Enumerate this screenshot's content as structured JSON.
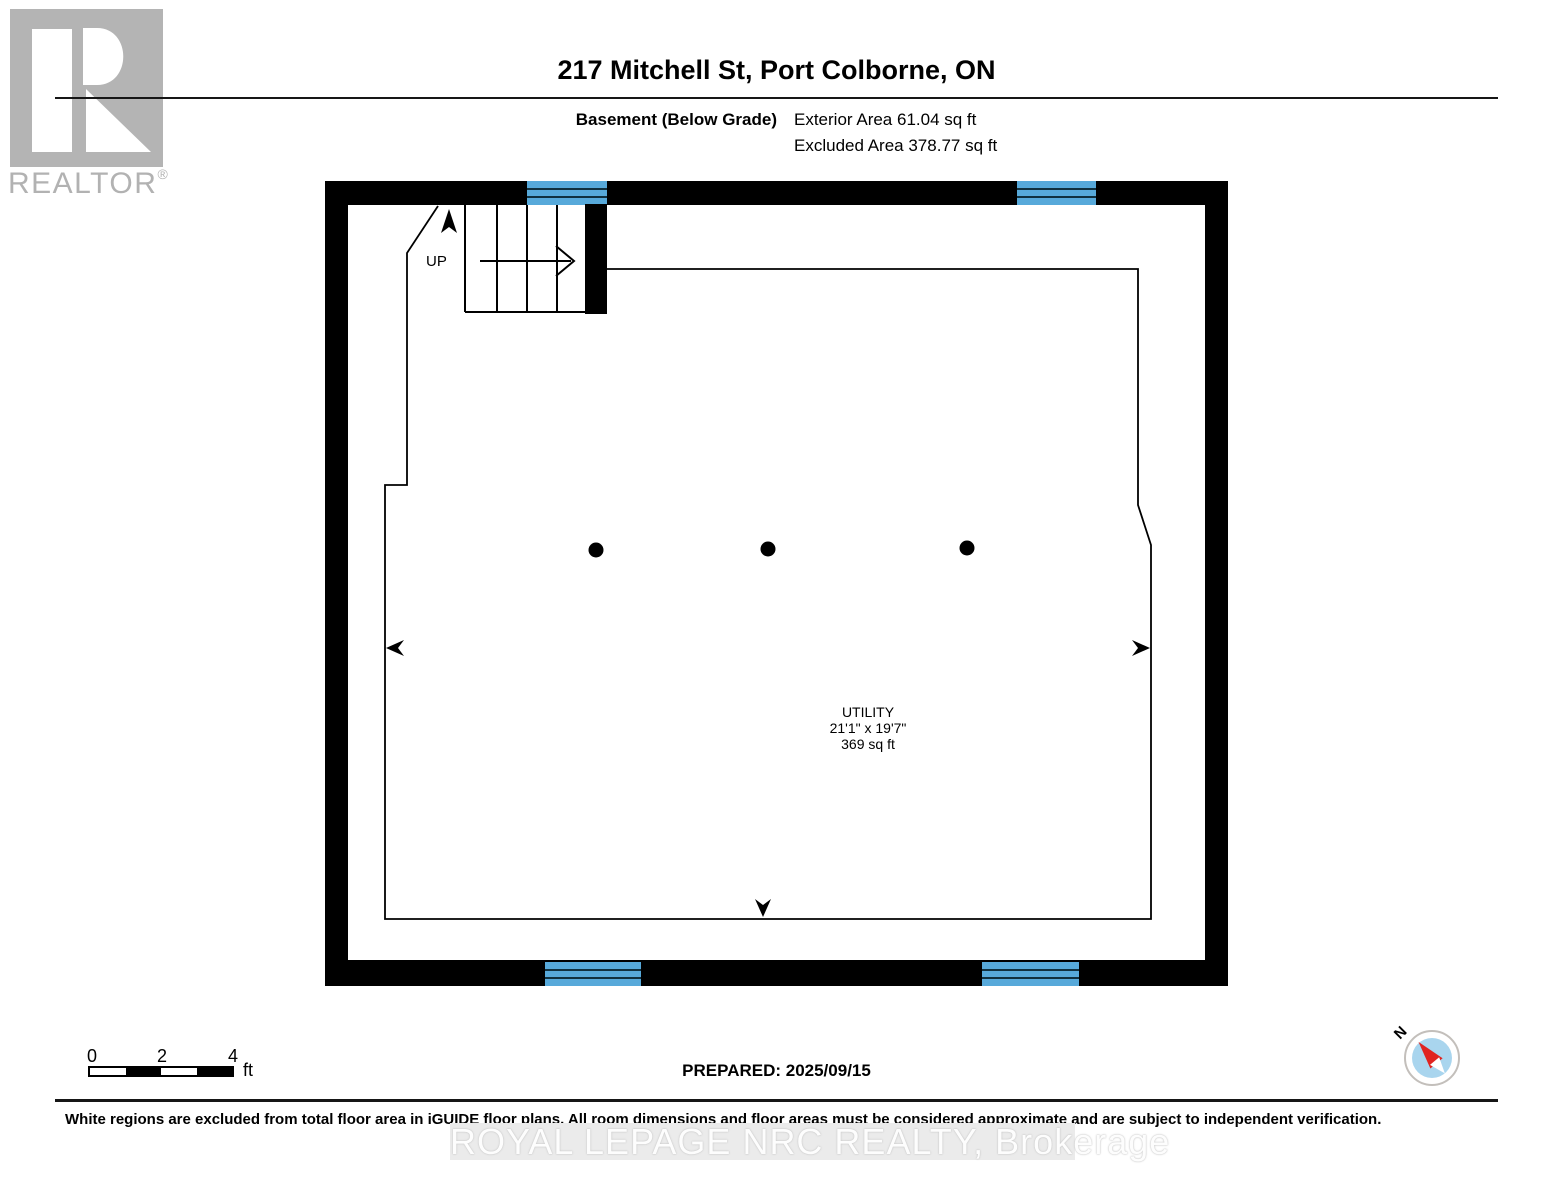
{
  "header": {
    "logo_word": "REALTOR",
    "logo_mark": "®",
    "title": "217 Mitchell St, Port Colborne, ON",
    "floor_label": "Basement (Below Grade)",
    "exterior_area": "Exterior Area 61.04 sq ft",
    "excluded_area": "Excluded Area 378.77 sq ft"
  },
  "floor_plan": {
    "stairs_up_label": "UP",
    "room": {
      "name": "UTILITY",
      "dimensions": "21'1\" x 19'7\"",
      "area": "369 sq ft"
    },
    "colors": {
      "wall": "#000000",
      "window": "#57a9da",
      "logo_gray": "#b4b4b4",
      "compass_blue": "#a9d5ee",
      "compass_red": "#e02421"
    }
  },
  "footer": {
    "scale_bar": {
      "ticks": [
        "0",
        "2",
        "4"
      ],
      "unit": "ft"
    },
    "prepared": "PREPARED: 2025/09/15",
    "compass_north": "N",
    "disclaimer": "White regions are excluded from total floor area in iGUIDE floor plans. All room dimensions and floor areas must be considered approximate and are subject to independent verification.",
    "watermark": "ROYAL LEPAGE NRC REALTY, Brokerage"
  }
}
